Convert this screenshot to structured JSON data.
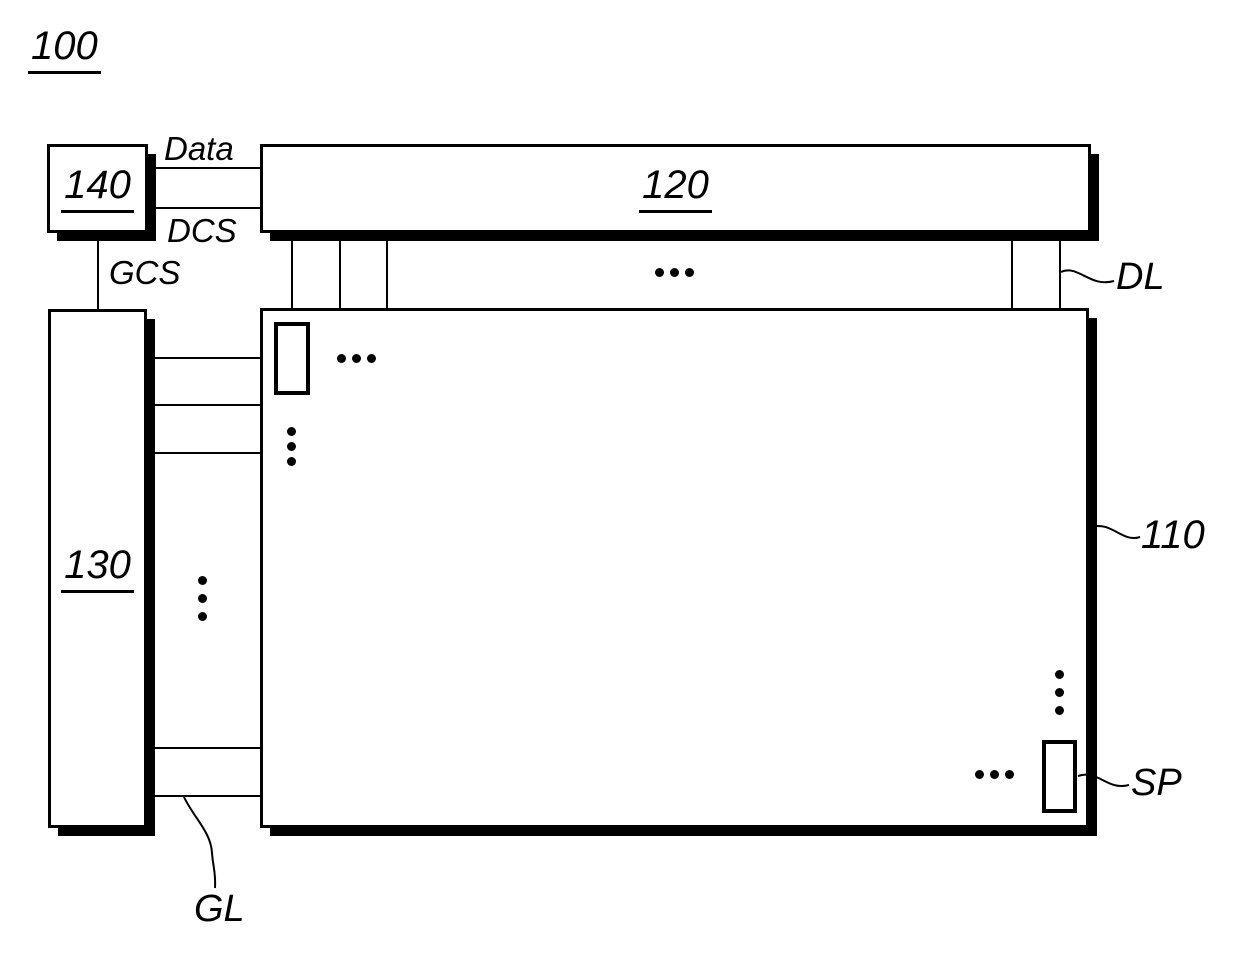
{
  "figure": {
    "ref_label": "100",
    "boxes": {
      "timing_controller": {
        "label": "140"
      },
      "data_driver": {
        "label": "120"
      },
      "gate_driver": {
        "label": "130"
      },
      "display_panel": {
        "label": "110"
      }
    },
    "signals": {
      "data": "Data",
      "dcs": "DCS",
      "gcs": "GCS"
    },
    "lines": {
      "data_line": "DL",
      "gate_line": "GL",
      "subpixel": "SP"
    },
    "colors": {
      "ink": "#000000",
      "background": "#ffffff"
    }
  }
}
